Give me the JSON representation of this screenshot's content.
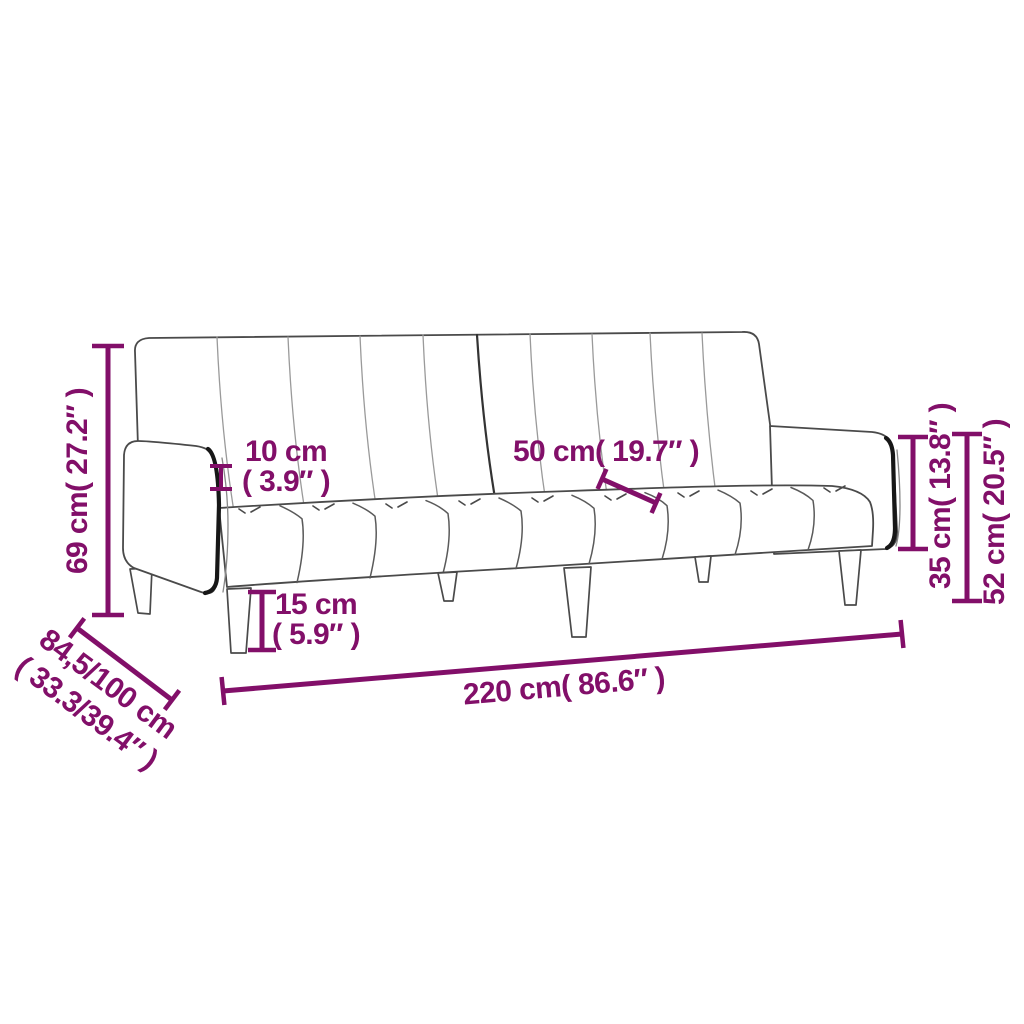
{
  "page": {
    "background": "#ffffff",
    "subject": "two-seater sofa bed line drawing with dimension annotations",
    "accent_color": "#820F69",
    "line_color": "#4a4a4a"
  },
  "labels": {
    "height69": "69 cm( 27.2″ )",
    "gap10a": "10 cm",
    "gap10b": "( 3.9″ )",
    "seat50": "50 cm( 19.7″ )",
    "leg15a": "15 cm",
    "leg15b": "( 5.9″ )",
    "arm35": "35 cm( 13.8″ )",
    "back52": "52 cm( 20.5″ )",
    "width220": "220 cm( 86.6″ )",
    "depth84a": "84,5/100 cm",
    "depth84b": "( 33.3/39.4″ )"
  }
}
